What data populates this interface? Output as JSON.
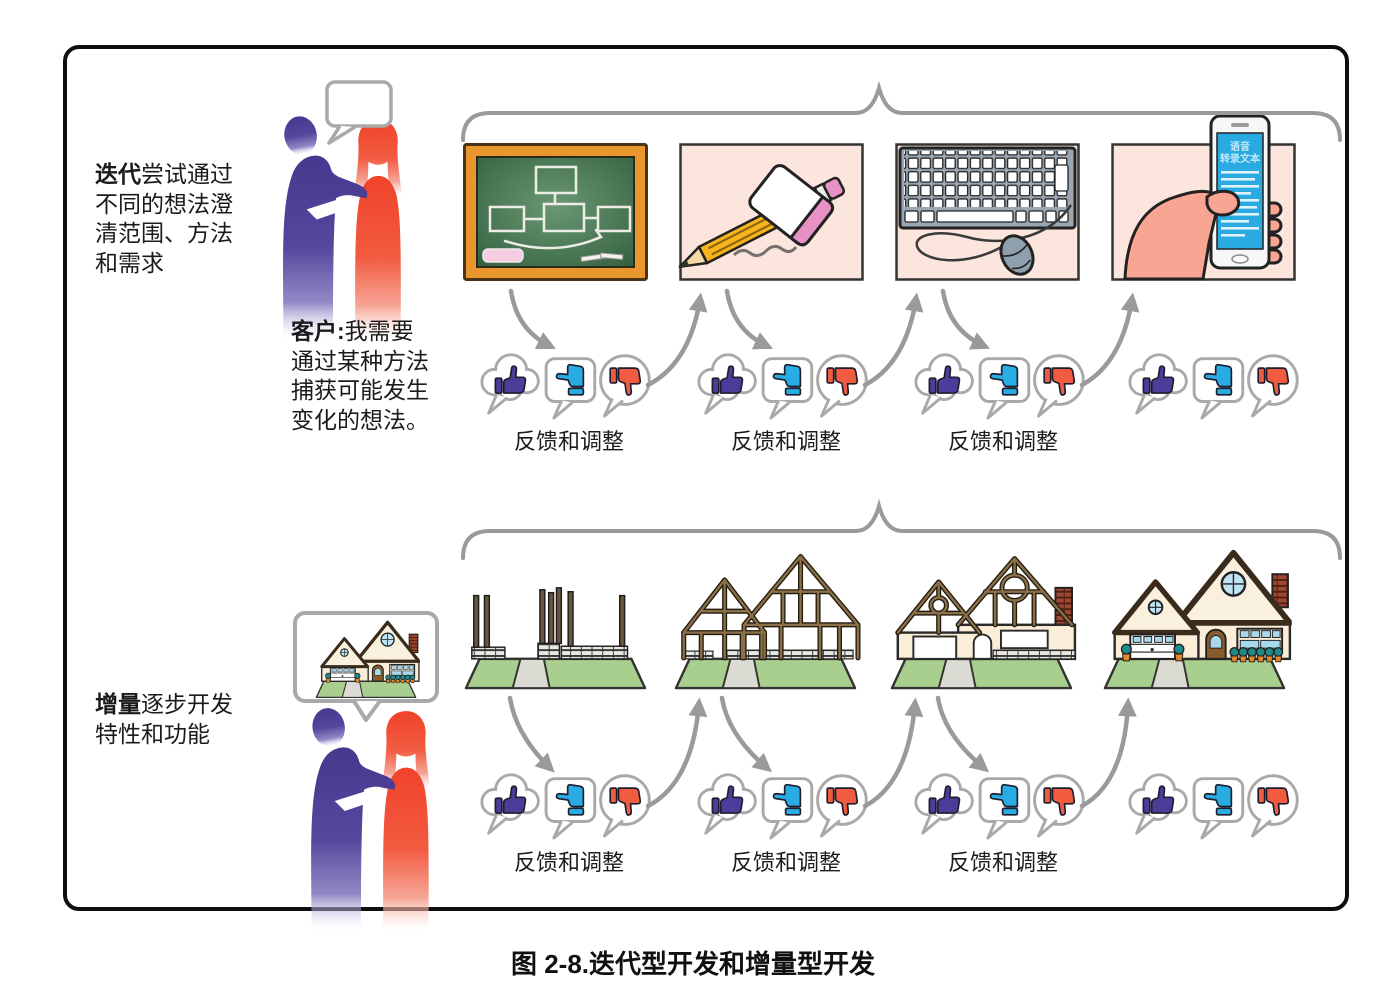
{
  "caption": "图 2-8.迭代型开发和增量型开发",
  "colors": {
    "purple_person": "#4B3B97",
    "orange_person": "#F1492F",
    "thumb_up_purple": "#4B3D99",
    "thumb_side_cyan": "#29ACE3",
    "thumb_down_orange": "#F15B40",
    "tile_pink_bg": "#FBE5DC",
    "board_green": "#3D6B49",
    "board_frame_orange": "#E9962F",
    "pencil_yellow": "#F9B41C",
    "eraser_pink": "#E891C4",
    "phone_screen_blue": "#29ABE2",
    "lawn_green": "#A9CF8E",
    "wall_cream": "#FBEED8",
    "arrow_gray": "#9A9A9A"
  },
  "icons": {
    "thumbs_up_icon": "👍",
    "thumbs_sideways_icon": "👍 (rotated left = neutral)",
    "thumbs_down_icon": "👎",
    "speech_bubble_icon": "💬",
    "brace_icon": "⏞"
  },
  "sections": {
    "iterative": {
      "title": {
        "bold": "迭代",
        "line1_rest": "尝试通过",
        "line2": "不同的想法澄",
        "line3": "清范围、方法",
        "line4": "和需求"
      },
      "customer": {
        "bold": "客户:",
        "line1_rest": "我需要",
        "line2": "通过某种方法",
        "line3": "捕获可能发生",
        "line4": "变化的想法。"
      },
      "artifacts": [
        "blackboard-flowchart",
        "pencil-and-eraser",
        "keyboard-and-mouse",
        "phone-voice-to-text"
      ],
      "phone_screen": {
        "line1": "语音",
        "line2": "转录文本"
      },
      "feedback_labels": [
        "反馈和调整",
        "反馈和调整",
        "反馈和调整"
      ]
    },
    "incremental": {
      "title": {
        "bold": "增量",
        "line1_rest": "逐步开发",
        "line2": "特性和功能"
      },
      "stages": [
        "foundation-posts",
        "timber-frame",
        "walls-partial",
        "finished-house"
      ],
      "feedback_labels": [
        "反馈和调整",
        "反馈和调整",
        "反馈和调整"
      ]
    }
  }
}
